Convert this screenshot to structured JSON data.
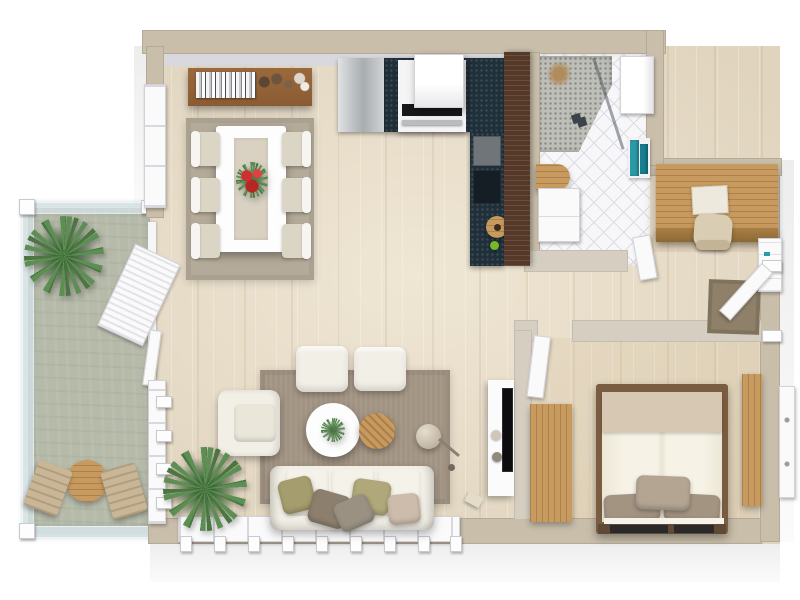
{
  "app": {
    "title": "3D Floor Plan — One-Bedroom Apartment with Balcony",
    "view": "top-down 3D render",
    "visible_text": []
  },
  "colors": {
    "wall_outer": "#c9beaa",
    "wall_inner_face": "#d8d8de",
    "wall_interior": "#d5cec1",
    "floor_wood": "#efe6d4",
    "floor_wood_streak": "#e0d4be",
    "balcony_floor": "#b6baa9",
    "railing_glass": "#d3e0e2",
    "tile_floor": "#f7f7f9",
    "tile_line": "#dcdce4",
    "pebble": "#bfbfb9",
    "pebble_dot": "#8d8d87",
    "counter_dark": "#20303a",
    "wood_dark": "#54392a",
    "wood_light": "#c79a5f",
    "rug_living": "#a29483",
    "rug_dining": "#b4aa99",
    "fabric_white": "#f2efe6",
    "cushion_olive": "#a59d6d",
    "cushion_brown": "#8d7f6d",
    "cushion_taupe": "#cdbcab",
    "cushion_grey": "#9b9183",
    "bed_blanket": "#d6c8b2",
    "bed_pillow": "#a39482",
    "teal_accent": "#2b9aa8",
    "red_accent": "#cf2f2f",
    "plant_green": "#5d8f55",
    "doormat": "#8f8069",
    "door_white": "#fafafb",
    "outdoor_chair": "#c9b696",
    "sideboard_wood": "#8a5b33"
  },
  "rooms": [
    {
      "id": "dining-area",
      "label": "Dining Area",
      "furniture": [
        "wall sideboard with books and vases",
        "white dining table with runner",
        "red flower centerpiece",
        "6 chairs",
        "area rug"
      ]
    },
    {
      "id": "kitchen",
      "label": "Kitchen",
      "furniture": [
        "refrigerator",
        "range with hood",
        "L-shaped dark countertop",
        "grey and dark cabinet fronts",
        "wooden bowl sink",
        "dark wood bar panel"
      ]
    },
    {
      "id": "bathroom",
      "label": "Bathroom",
      "furniture": [
        "corner shower with pebble floor and glass door",
        "wall cabinet",
        "teal towels on rail",
        "wood vanity top",
        "white vanity cabinet",
        "diagonal tile floor",
        "door"
      ]
    },
    {
      "id": "entry-hall",
      "label": "Entry Hall",
      "furniture": [
        "built-in wood desk",
        "laptop",
        "desk chair",
        "entry door",
        "doormat",
        "white wall cabinet"
      ]
    },
    {
      "id": "living-room",
      "label": "Living Room",
      "furniture": [
        "three-seat sofa with five cushions",
        "armchair",
        "two ottomans",
        "round white coffee table with plant",
        "round wood side table",
        "floor lamp",
        "area rug",
        "potted palm",
        "tv console with tv"
      ]
    },
    {
      "id": "bedroom",
      "label": "Bedroom",
      "furniture": [
        "double bed with pillows and blanket",
        "wardrobe",
        "tall wood cabinet",
        "window shutter",
        "door"
      ]
    },
    {
      "id": "balcony",
      "label": "Balcony",
      "furniture": [
        "glass railing",
        "potted palm",
        "round bistro table",
        "two outdoor chairs",
        "open louvered bi-fold door"
      ]
    }
  ]
}
